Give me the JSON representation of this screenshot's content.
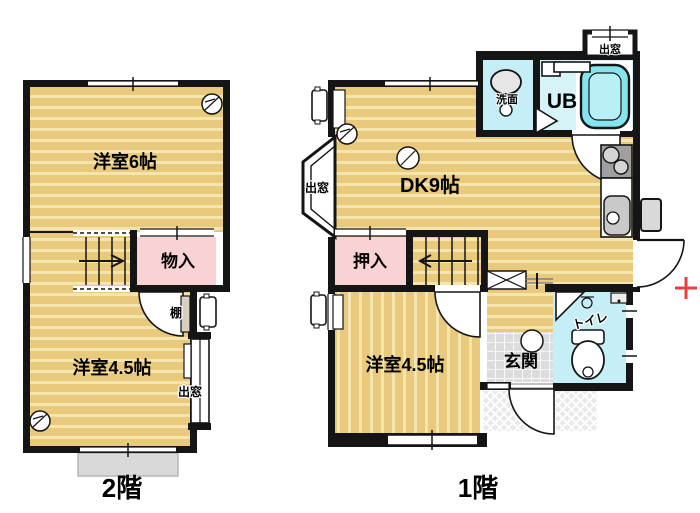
{
  "floor2": {
    "label": "2階",
    "room6": "洋室6帖",
    "storage": "物入",
    "shelf": "棚",
    "bay_window": "出窓",
    "room45": "洋室4.5帖"
  },
  "floor1": {
    "label": "1階",
    "dk": "DK9帖",
    "closet": "押入",
    "room45": "洋室4.5帖",
    "entrance": "玄関",
    "toilet": "トイレ",
    "bath": "UB",
    "washroom": "洗面",
    "bay_window_left": "出窓",
    "bay_window_top": "出窓"
  },
  "colors": {
    "wall": "#151515",
    "floor_tan": "#e9c97b",
    "floor_stripe": "#f4e5ae",
    "closet_pink": "#f9d3d3",
    "wet_room_cyan": "#c6eef7",
    "bathtub_cyan": "#85e4ee",
    "tile_gray": "#dcdcdc",
    "balcony_gray": "#d9d9d9",
    "marker_red": "#e84040"
  }
}
